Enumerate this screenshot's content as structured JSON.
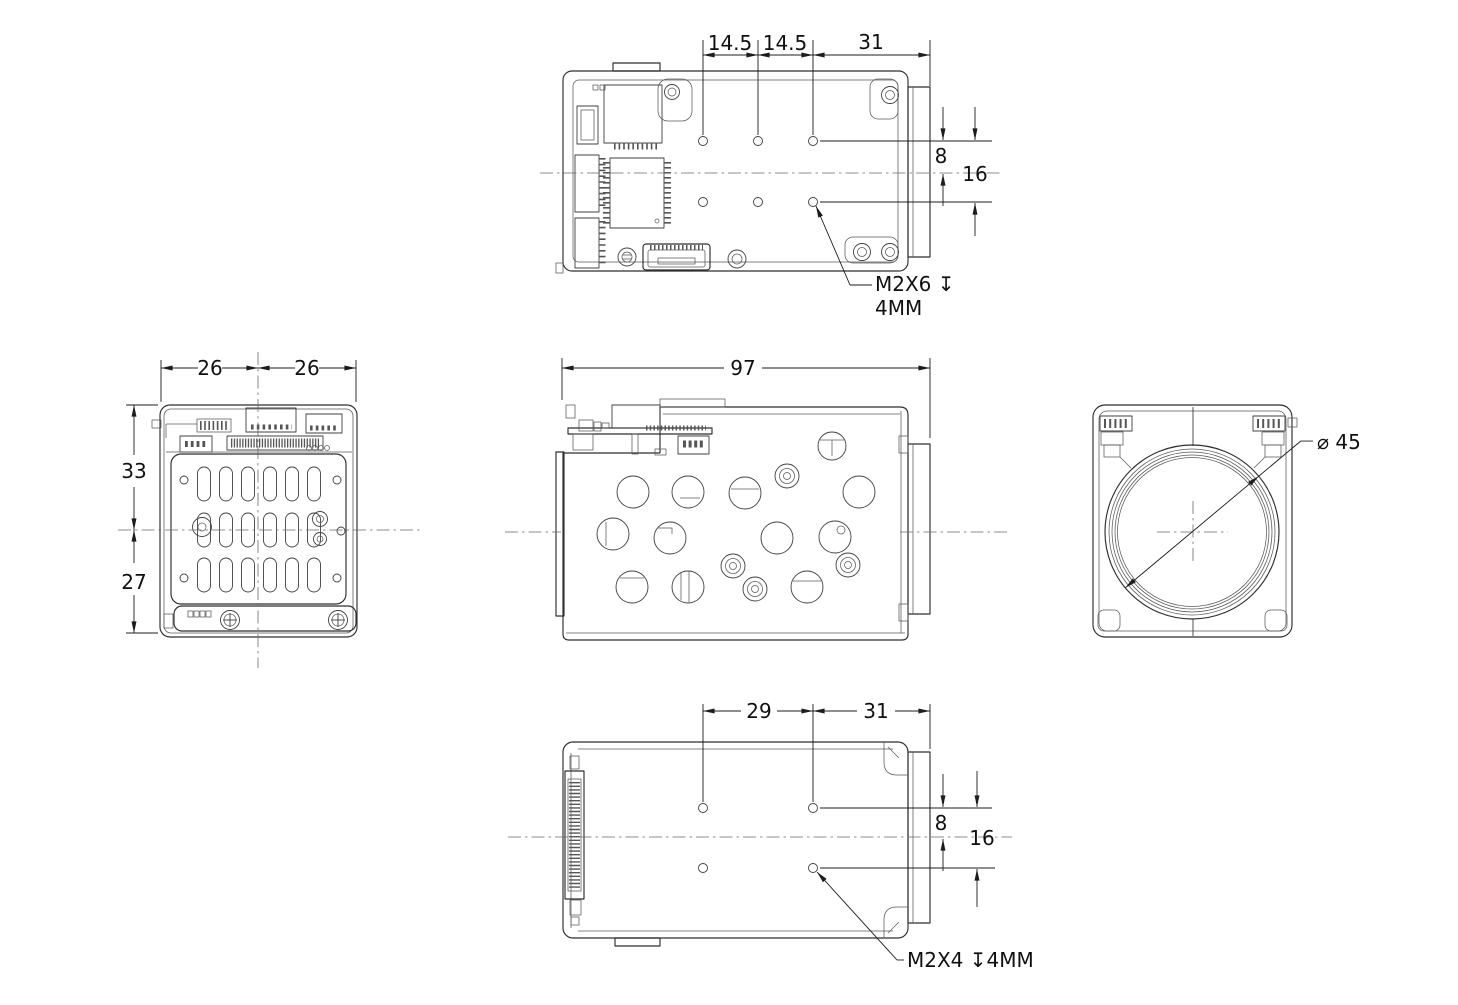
{
  "colors": {
    "background": "#ffffff",
    "ink": "#2e2e2e"
  },
  "views": {
    "top": {
      "dims": {
        "pitch_a": "14.5",
        "pitch_b": "14.5",
        "edge_to_lens": "31",
        "hole_to_center": "8",
        "hole_span": "16"
      },
      "thread_note": {
        "line1": "M2X6 ↧",
        "line2": "4MM"
      }
    },
    "rear": {
      "dims": {
        "half_width_a": "26",
        "half_width_b": "26",
        "height_upper": "33",
        "height_lower": "27"
      }
    },
    "side": {
      "dims": {
        "overall_length": "97"
      }
    },
    "front": {
      "dims": {
        "lens_diameter": "⌀ 45"
      }
    },
    "bottom": {
      "dims": {
        "hole_pitch": "29",
        "edge_to_lens": "31",
        "hole_to_center": "8",
        "hole_span": "16"
      },
      "thread_note": "M2X4 ↧4MM"
    }
  }
}
